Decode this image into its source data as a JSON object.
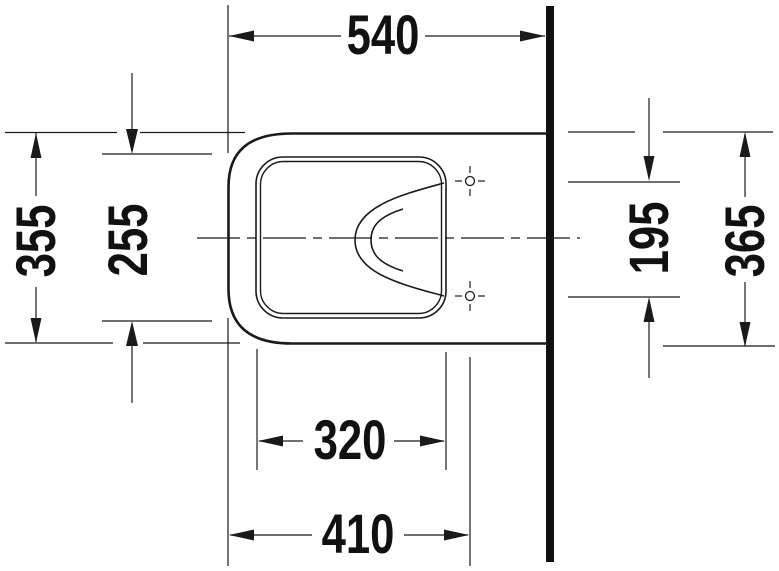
{
  "drawing": {
    "type": "technical-dimension-drawing",
    "subject": "wall-hung-toilet-top-view",
    "colors": {
      "line": "#1a1a1a",
      "background": "#ffffff",
      "wall": "#111111"
    },
    "dimensions": {
      "total_depth_to_wall": "540",
      "outer_width": "355",
      "seat_opening_width": "255",
      "mounting_hole_spacing": "195",
      "body_width_at_wall": "365",
      "seat_opening_depth": "320",
      "front_to_mounting_holes": "410"
    }
  }
}
